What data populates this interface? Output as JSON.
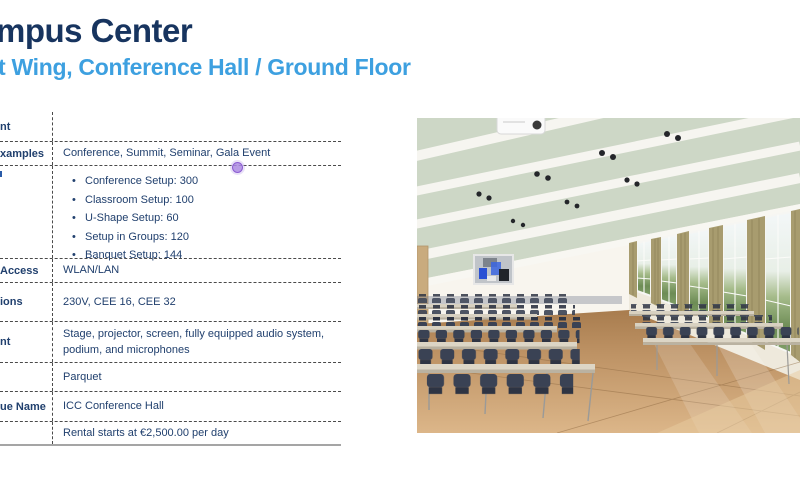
{
  "slide": {
    "title": "mpus Center",
    "subtitle": "t Wing, Conference Hall / Ground Floor"
  },
  "info_table": {
    "rows": [
      {
        "label": "nt",
        "value": ""
      },
      {
        "label": "xamples",
        "value": "Conference, Summit, Seminar, Gala Event"
      },
      {
        "label": "",
        "bullets": [
          "Conference Setup: 300",
          "Classroom Setup: 100",
          "U-Shape Setup: 60",
          "Setup in Groups: 120",
          "Banquet Setup: 144"
        ]
      },
      {
        "label": "Access",
        "value": "WLAN/LAN"
      },
      {
        "label": "ions",
        "value": "230V, CEE 16, CEE 32"
      },
      {
        "label": "nt",
        "value": "Stage, projector, screen, fully equipped audio system, podium, and microphones"
      },
      {
        "label": "",
        "value": "Parquet"
      },
      {
        "label": "ue Name",
        "value": "ICC Conference Hall"
      },
      {
        "label": "",
        "value": "Rental starts at €2,500.00 per day"
      }
    ]
  },
  "photo": {
    "description": "Conference hall with classroom-style rows of tables and dark blue chairs, tall windows with olive curtains on the right, pale green ceiling with white beams, spotlights and a projector, abstract blue painting on the back wall, parquet wood floor"
  },
  "colors": {
    "title": "#17345f",
    "subtitle": "#3da0e0",
    "table_text": "#21406e",
    "table_dash": "#4a4a4a",
    "table_bottom_line": "#a5a5a5",
    "presence_cursor": "#ac8ae2"
  }
}
